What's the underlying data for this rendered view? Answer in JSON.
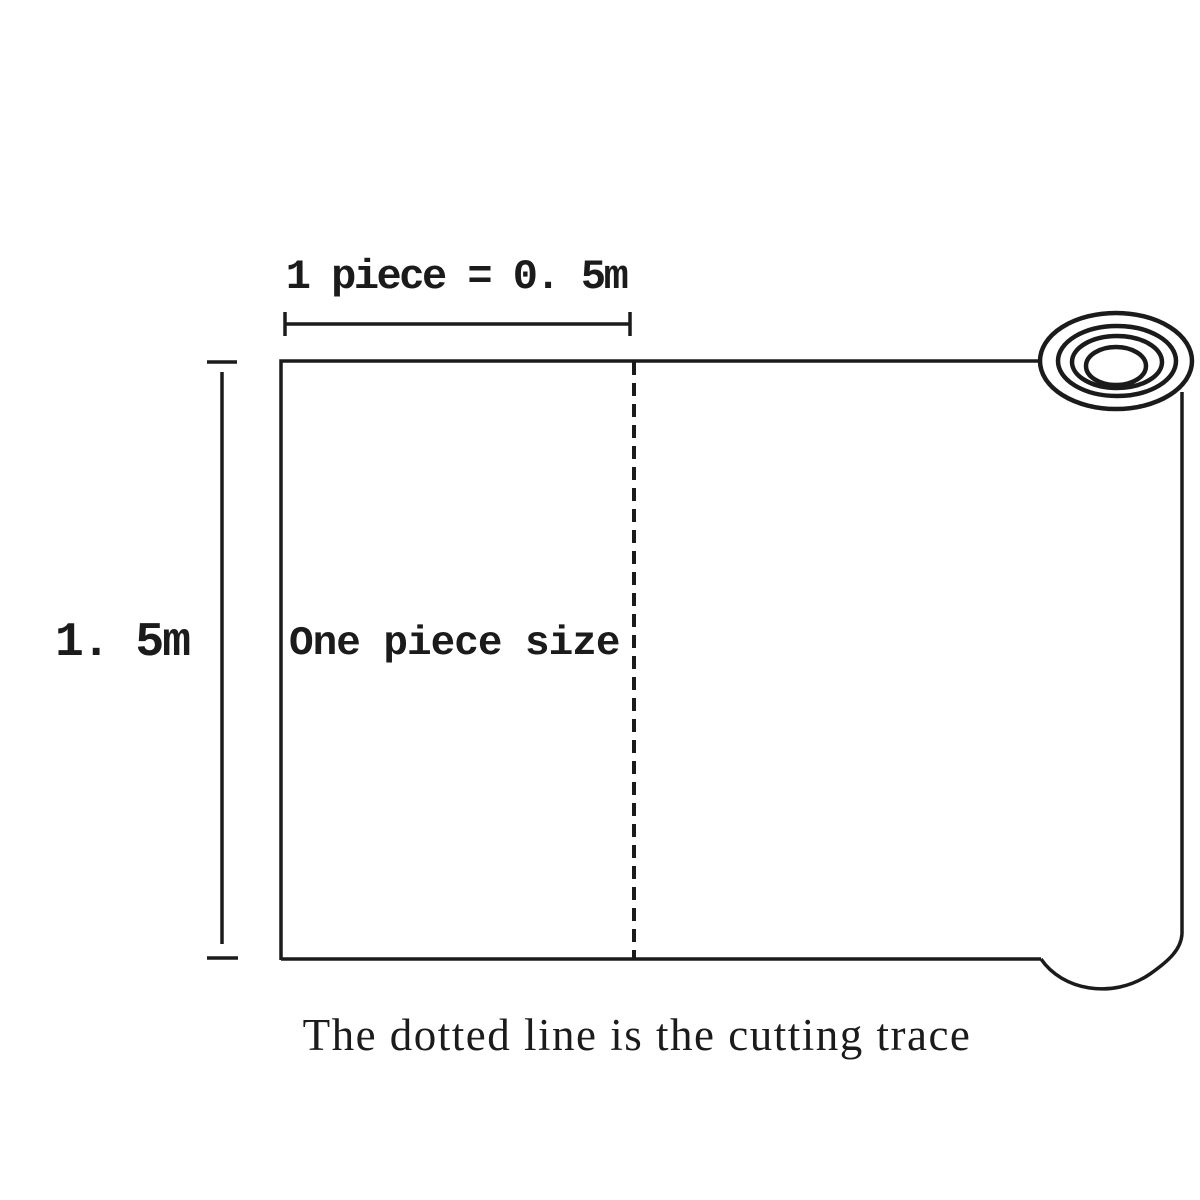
{
  "diagram": {
    "top_dimension_label": "1 piece = 0. 5m",
    "left_dimension_label": "1. 5m",
    "piece_label": "One piece size",
    "caption": "The dotted line is the cutting trace",
    "colors": {
      "line": "#1b1b1b",
      "background": "#ffffff"
    }
  }
}
